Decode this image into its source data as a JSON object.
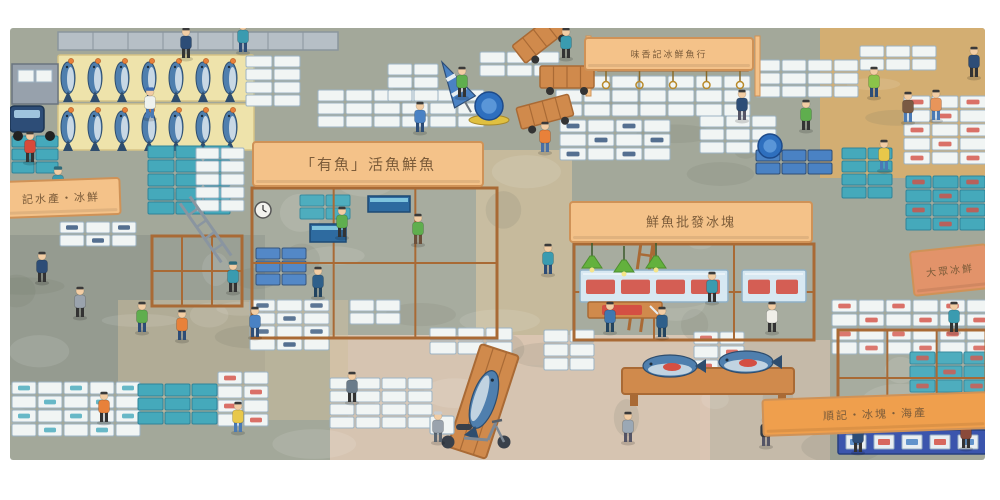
{
  "meta": {
    "alt": "Watercolor cartoon illustration, overhead view of a busy fish market: rows of large blue fish on cream pallets, stacks of white and teal foam boxes, wooden stall frames with orange signboards in Chinese, hand carts, a scooter, green pendant lamps and many small workers and shoppers."
  },
  "palette": {
    "page_bg": "#ffffff",
    "floor": "#a3a89a",
    "floor_shadow": "#8e968b",
    "aisle_tan": "#d8ae6e",
    "aisle_pink": "#dcc6b4",
    "aisle_warm": "#cdbd9c",
    "sign_peach": "#f4c289",
    "sign_orange": "#ef9f4d",
    "sign_salmon": "#e2936a",
    "sign_border": "#cf9257",
    "sign_text": "#7c5c3a",
    "box_white": "#f1f5f4",
    "box_edge": "#9db4c4",
    "box_teal": "#45a9bb",
    "box_teal_dark": "#2f8499",
    "crate_blue": "#4a82c4",
    "navy": "#2d4d77",
    "wood": "#d08a4c",
    "wood_dark": "#a96a35",
    "pallet_cream": "#eee3ab",
    "fish_blue": "#4f7fae",
    "fish_belly": "#dde8ee",
    "fish_dark": "#2e4d6e",
    "tuna_red": "#d44f43",
    "skin": "#f2cda4",
    "lamp_green": "#63b13d",
    "banner_blue": "#3b55ad",
    "barrel_blue": "#2e6fbe"
  },
  "signs": [
    {
      "id": "sign-top-hook-stall",
      "text": "味香記冰鮮魚行",
      "x": 585,
      "y": 38,
      "w": 168,
      "h": 32,
      "angle": 0,
      "bg": "peach",
      "font": 9
    },
    {
      "id": "sign-live-fish",
      "text": "「有魚」活魚鮮魚",
      "x": 253,
      "y": 142,
      "w": 230,
      "h": 44,
      "angle": 0,
      "bg": "peach",
      "font": 15
    },
    {
      "id": "sign-left-ice",
      "text": "記水產・冰鮮",
      "x": 2,
      "y": 180,
      "w": 118,
      "h": 36,
      "angle": -2,
      "bg": "peach",
      "font": 11
    },
    {
      "id": "sign-wholesale",
      "text": "鮮魚批發冰塊",
      "x": 570,
      "y": 202,
      "w": 242,
      "h": 40,
      "angle": 0,
      "bg": "peach",
      "font": 13
    },
    {
      "id": "sign-right-edge",
      "text": "大眾冰鮮",
      "x": 912,
      "y": 248,
      "w": 76,
      "h": 44,
      "angle": -6,
      "bg": "salmon",
      "font": 10
    },
    {
      "id": "sign-bottom-right",
      "text": "順記・冰塊・海產",
      "x": 763,
      "y": 396,
      "w": 224,
      "h": 36,
      "angle": -2,
      "bg": "orange",
      "font": 11
    }
  ],
  "scene": {
    "floor_patches": [
      {
        "x": 820,
        "y": 28,
        "w": 168,
        "h": 150,
        "c": "aisle_tan",
        "o": 0.9
      },
      {
        "x": 476,
        "y": 150,
        "w": 96,
        "h": 215,
        "c": "aisle_warm",
        "o": 0.85
      },
      {
        "x": 330,
        "y": 335,
        "w": 380,
        "h": 125,
        "c": "aisle_pink",
        "o": 0.9
      },
      {
        "x": 10,
        "y": 235,
        "w": 255,
        "h": 150,
        "c": "floor_shadow",
        "o": 0.7
      },
      {
        "x": 118,
        "y": 300,
        "w": 230,
        "h": 120,
        "c": "aisle_warm",
        "o": 0.5
      },
      {
        "x": 700,
        "y": 340,
        "w": 130,
        "h": 120,
        "c": "aisle_pink",
        "o": 0.6
      }
    ],
    "pallets": [
      {
        "x": 58,
        "y": 55,
        "w": 196,
        "h": 46
      },
      {
        "x": 58,
        "y": 104,
        "w": 196,
        "h": 46
      }
    ],
    "fish_rows": [
      {
        "x": 68,
        "y": 78,
        "n": 7,
        "dx": 27
      },
      {
        "x": 68,
        "y": 127,
        "n": 7,
        "dx": 27
      }
    ],
    "stacks": [
      {
        "x": 246,
        "y": 56,
        "cols": 2,
        "rows": 4,
        "bw": 26,
        "bh": 11,
        "c": "box_white"
      },
      {
        "x": 318,
        "y": 90,
        "cols": 6,
        "rows": 3,
        "bw": 26,
        "bh": 11,
        "c": "box_white"
      },
      {
        "x": 480,
        "y": 52,
        "cols": 3,
        "rows": 2,
        "bw": 25,
        "bh": 11,
        "c": "box_white"
      },
      {
        "x": 388,
        "y": 64,
        "cols": 2,
        "rows": 3,
        "bw": 24,
        "bh": 11,
        "c": "box_white"
      },
      {
        "x": 556,
        "y": 76,
        "cols": 7,
        "rows": 3,
        "bw": 26,
        "bh": 12,
        "c": "box_white"
      },
      {
        "x": 560,
        "y": 120,
        "cols": 4,
        "rows": 3,
        "bw": 26,
        "bh": 12,
        "c": "box_white",
        "deco": "navy"
      },
      {
        "x": 700,
        "y": 116,
        "cols": 3,
        "rows": 3,
        "bw": 24,
        "bh": 11,
        "c": "box_white"
      },
      {
        "x": 756,
        "y": 60,
        "cols": 4,
        "rows": 3,
        "bw": 24,
        "bh": 11,
        "c": "box_white"
      },
      {
        "x": 860,
        "y": 46,
        "cols": 3,
        "rows": 2,
        "bw": 24,
        "bh": 11,
        "c": "box_white"
      },
      {
        "x": 904,
        "y": 96,
        "cols": 3,
        "rows": 5,
        "bw": 26,
        "bh": 12,
        "c": "box_white",
        "deco": "red"
      },
      {
        "x": 842,
        "y": 148,
        "cols": 2,
        "rows": 4,
        "bw": 24,
        "bh": 11,
        "c": "box_teal"
      },
      {
        "x": 906,
        "y": 176,
        "cols": 3,
        "rows": 4,
        "bw": 25,
        "bh": 12,
        "c": "box_teal",
        "deco": "red"
      },
      {
        "x": 148,
        "y": 146,
        "cols": 3,
        "rows": 5,
        "bw": 26,
        "bh": 12,
        "c": "box_teal"
      },
      {
        "x": 196,
        "y": 148,
        "cols": 2,
        "rows": 5,
        "bw": 23,
        "bh": 11,
        "c": "box_white"
      },
      {
        "x": 12,
        "y": 136,
        "cols": 2,
        "rows": 3,
        "bw": 22,
        "bh": 11,
        "c": "box_teal"
      },
      {
        "x": 60,
        "y": 222,
        "cols": 3,
        "rows": 2,
        "bw": 24,
        "bh": 11,
        "c": "box_white",
        "deco": "navy"
      },
      {
        "x": 256,
        "y": 248,
        "cols": 2,
        "rows": 3,
        "bw": 24,
        "bh": 11,
        "c": "crate_blue"
      },
      {
        "x": 300,
        "y": 195,
        "cols": 2,
        "rows": 2,
        "bw": 24,
        "bh": 11,
        "c": "box_teal"
      },
      {
        "x": 250,
        "y": 300,
        "cols": 3,
        "rows": 4,
        "bw": 25,
        "bh": 11,
        "c": "box_white",
        "deco": "navy"
      },
      {
        "x": 350,
        "y": 300,
        "cols": 2,
        "rows": 2,
        "bw": 24,
        "bh": 11,
        "c": "box_white"
      },
      {
        "x": 12,
        "y": 382,
        "cols": 5,
        "rows": 4,
        "bw": 24,
        "bh": 12,
        "c": "box_white",
        "deco": "teal"
      },
      {
        "x": 138,
        "y": 384,
        "cols": 3,
        "rows": 3,
        "bw": 25,
        "bh": 12,
        "c": "box_teal"
      },
      {
        "x": 218,
        "y": 372,
        "cols": 2,
        "rows": 4,
        "bw": 24,
        "bh": 12,
        "c": "box_white",
        "deco": "red"
      },
      {
        "x": 330,
        "y": 378,
        "cols": 4,
        "rows": 4,
        "bw": 24,
        "bh": 11,
        "c": "box_white"
      },
      {
        "x": 430,
        "y": 328,
        "cols": 3,
        "rows": 2,
        "bw": 26,
        "bh": 12,
        "c": "box_white"
      },
      {
        "x": 544,
        "y": 330,
        "cols": 2,
        "rows": 3,
        "bw": 24,
        "bh": 12,
        "c": "box_white"
      },
      {
        "x": 694,
        "y": 332,
        "cols": 2,
        "rows": 4,
        "bw": 24,
        "bh": 12,
        "c": "box_white",
        "deco": "red"
      },
      {
        "x": 832,
        "y": 300,
        "cols": 6,
        "rows": 4,
        "bw": 25,
        "bh": 12,
        "c": "box_white",
        "deco": "red"
      },
      {
        "x": 910,
        "y": 352,
        "cols": 3,
        "rows": 3,
        "bw": 25,
        "bh": 12,
        "c": "box_teal",
        "deco": "red"
      },
      {
        "x": 756,
        "y": 150,
        "cols": 3,
        "rows": 2,
        "bw": 24,
        "bh": 11,
        "c": "crate_blue"
      }
    ],
    "shelves": [
      {
        "x": 252,
        "y": 188,
        "w": 245,
        "h": 150
      },
      {
        "x": 574,
        "y": 244,
        "w": 240,
        "h": 96
      },
      {
        "x": 838,
        "y": 330,
        "w": 148,
        "h": 96
      },
      {
        "x": 152,
        "y": 236,
        "w": 90,
        "h": 70
      }
    ],
    "props": [
      {
        "t": "toprow",
        "x": 58,
        "y": 32,
        "w": 280,
        "h": 18
      },
      {
        "t": "truck",
        "x": 10,
        "y": 44
      },
      {
        "t": "hookbar",
        "x": 596,
        "y": 66,
        "w": 154,
        "n": 5
      },
      {
        "t": "parasol",
        "x": 442,
        "y": 62,
        "a": -30
      },
      {
        "t": "cart",
        "x": 512,
        "y": 46,
        "a": -38
      },
      {
        "t": "cart",
        "x": 516,
        "y": 108,
        "a": -15
      },
      {
        "t": "cart",
        "x": 540,
        "y": 66,
        "a": 0
      },
      {
        "t": "barrel",
        "x": 489,
        "y": 106,
        "r": 14,
        "dolly": true
      },
      {
        "t": "barrel",
        "x": 770,
        "y": 146,
        "r": 12
      },
      {
        "t": "clock",
        "x": 263,
        "y": 210,
        "r": 8
      },
      {
        "t": "ladder",
        "x": 185,
        "y": 200,
        "h": 72,
        "a": -35,
        "c": "#8a95a0"
      },
      {
        "t": "ladder",
        "x": 648,
        "y": 236,
        "h": 96,
        "a": 8,
        "c": "wood_dark"
      },
      {
        "t": "tank",
        "x": 368,
        "y": 196,
        "w": 42,
        "h": 16
      },
      {
        "t": "tank",
        "x": 310,
        "y": 224,
        "w": 36,
        "h": 18
      },
      {
        "t": "case",
        "x": 580,
        "y": 270,
        "w": 148,
        "h": 32
      },
      {
        "t": "case",
        "x": 742,
        "y": 270,
        "w": 64,
        "h": 32
      },
      {
        "t": "cutting",
        "x": 588,
        "y": 302,
        "w": 74,
        "h": 16
      },
      {
        "t": "lamp",
        "x": 592,
        "y": 268
      },
      {
        "t": "lamp",
        "x": 624,
        "y": 272
      },
      {
        "t": "lamp",
        "x": 656,
        "y": 268
      },
      {
        "t": "lamp",
        "x": 848,
        "y": 424
      },
      {
        "t": "lamp",
        "x": 952,
        "y": 424
      },
      {
        "t": "board",
        "x": 500,
        "y": 350,
        "a": 18
      },
      {
        "t": "bigtable",
        "x": 622,
        "y": 352
      },
      {
        "t": "scooter",
        "x": 430,
        "y": 398
      },
      {
        "t": "banner",
        "x": 838,
        "y": 430,
        "w": 148,
        "h": 24
      }
    ],
    "people": [
      [
        150,
        118,
        "#eef2ee",
        "#4a7ab5",
        "#3a6ab0"
      ],
      [
        186,
        58,
        "#2d4d77",
        "#333333",
        null
      ],
      [
        243,
        52,
        "#3a9bb0",
        "#2d4d77",
        null
      ],
      [
        420,
        132,
        "#4a82c4",
        "#2d4d77",
        null
      ],
      [
        462,
        97,
        "#5fae4e",
        "#333333",
        null
      ],
      [
        545,
        152,
        "#e8813a",
        "#4a6fa5",
        null
      ],
      [
        566,
        58,
        "#3a9bb0",
        "#333333",
        null
      ],
      [
        742,
        120,
        "#2d4d77",
        "#555566",
        null
      ],
      [
        806,
        130,
        "#5fae4e",
        "#333333",
        null
      ],
      [
        874,
        97,
        "#8bc34a",
        "#2d4d77",
        null
      ],
      [
        908,
        122,
        "#7a5a43",
        "#4a7ab5",
        null
      ],
      [
        936,
        120,
        "#e8955a",
        "#4a7ab5",
        null
      ],
      [
        974,
        77,
        "#2d4d77",
        "#333333",
        null
      ],
      [
        884,
        170,
        "#e8c84a",
        "#4a7ab5",
        null
      ],
      [
        30,
        162,
        "#d84a3a",
        "#333333",
        null
      ],
      [
        58,
        197,
        "#3a9bb0",
        "#2d4d77",
        "#2d6a7a"
      ],
      [
        42,
        282,
        "#2d4d77",
        "#333333",
        null
      ],
      [
        80,
        317,
        "#9aa3ad",
        "#333333",
        null
      ],
      [
        142,
        332,
        "#5fae4e",
        "#2d4d77",
        null
      ],
      [
        182,
        340,
        "#e8813a",
        "#2d4d77",
        null
      ],
      [
        233,
        292,
        "#3a9bb0",
        "#333333",
        "#2d6a7a"
      ],
      [
        255,
        337,
        "#4a82c4",
        "#2d4d77",
        null
      ],
      [
        318,
        297,
        "#2e5f8a",
        "#23445f",
        null
      ],
      [
        342,
        237,
        "#5fae4e",
        "#333333",
        null
      ],
      [
        418,
        244,
        "#5fae4e",
        "#6b4f3a",
        null
      ],
      [
        548,
        274,
        "#3a9bb0",
        "#2d4d77",
        null
      ],
      [
        610,
        332,
        "#4178b0",
        "#23445f",
        null
      ],
      [
        662,
        337,
        "#2e5f8a",
        "#23445f",
        null
      ],
      [
        712,
        302,
        "#3a9bb0",
        "#333333",
        null
      ],
      [
        772,
        332,
        "#f0efe8",
        "#333333",
        null
      ],
      [
        954,
        332,
        "#3a9bb0",
        "#333333",
        null
      ],
      [
        104,
        422,
        "#e8813a",
        "#333333",
        null
      ],
      [
        238,
        432,
        "#e8c84a",
        "#4a7ab5",
        null
      ],
      [
        352,
        402,
        "#6a7b8a",
        "#333333",
        null
      ],
      [
        438,
        442,
        "#9aa3ad",
        "#5a6570",
        "#c8ccd0"
      ],
      [
        628,
        442,
        "#9ba8b5",
        "#555566",
        null
      ],
      [
        766,
        446,
        "#333b44",
        "#555566",
        null
      ],
      [
        858,
        452,
        "#2d4d77",
        "#333333",
        null
      ],
      [
        966,
        448,
        "#8a4a3a",
        "#333333",
        null
      ]
    ]
  }
}
